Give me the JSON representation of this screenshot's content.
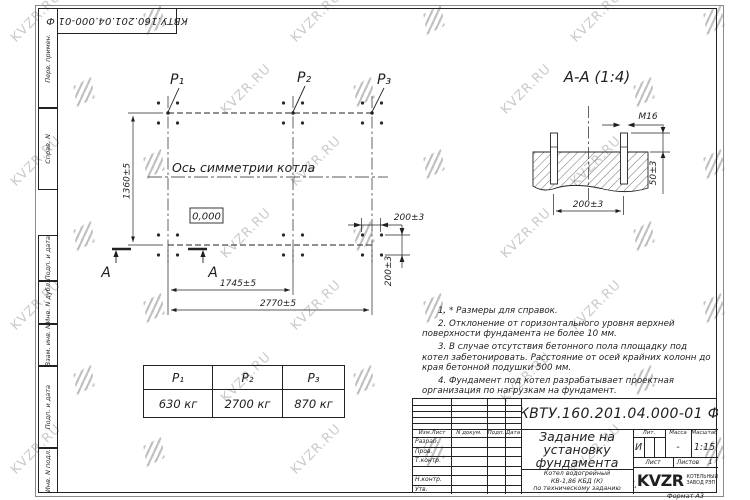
{
  "watermark": {
    "text": "KVZR.RU"
  },
  "frame": {
    "doc_code_rotated": "КВТУ.160.201.04.000-01 Ф",
    "stamp_cells": [
      "Перв. примен.",
      "Справ. N",
      "Подп. и дата",
      "Инв. N дубл.",
      "Взам. инв. N",
      "Подп. и дата",
      "Инв. N подл."
    ],
    "format_note": "Формат А3"
  },
  "plan": {
    "point_labels": [
      "P₁",
      "P₂",
      "P₃"
    ],
    "axis_label": "Ось симметрии котла",
    "level_mark": "0,000",
    "cut_letter": "А",
    "dims": {
      "height": "1360±5",
      "to_p2": "1745±5",
      "width": "2770±5",
      "bolt_spacing_h": "200±3",
      "bolt_spacing_v": "200±3"
    }
  },
  "section": {
    "title": "А-А (1:4)",
    "thread_label": "М16",
    "dims": {
      "bolt_spacing": "200±3",
      "protrusion": "50±3"
    }
  },
  "notes": [
    "1. * Размеры для справок.",
    "2. Отклонение от горизонтального уровня верхней поверхности фундамента не более 10 мм.",
    "3. В случае отсутствия бетонного пола площадку под котел забетонировать. Расстояние от осей крайних колонн до края бетонной подушки 500 мм.",
    "4. Фундамент под котел разрабатывает проектная организация по нагрузкам на фундамент."
  ],
  "load_table": {
    "headers": [
      "P₁",
      "P₂",
      "P₃"
    ],
    "values": [
      "630 кг",
      "2700 кг",
      "870 кг"
    ]
  },
  "title_block": {
    "designation": "КВТУ.160.201.04.000-01 Ф",
    "title_lines": [
      "Задание на",
      "установку",
      "фундамента"
    ],
    "product_lines": [
      "Котел водогрейный",
      "КВ-1,86 КБД (К)",
      "по техническому заданию"
    ],
    "rev_cols": [
      "Изм.Лист",
      "N докум.",
      "Подп.",
      "Дата"
    ],
    "sign_rows": [
      "Разраб.",
      "Пров.",
      "Т.контр.",
      "",
      "Н.контр.",
      "Утв."
    ],
    "lit_label": "Лит.",
    "lit_value": "И",
    "mass_label": "Масса",
    "mass_value": "-",
    "scale_label": "Масштаб",
    "scale_value": "1:15",
    "sheet_label": "Лист",
    "sheets_label": "Листов",
    "sheets_value": "1",
    "company": {
      "logo_text": "KVZR",
      "caption_lines": [
        "КОТЕЛЬНЫЙ",
        "ЗАВОД РЭП"
      ]
    }
  }
}
